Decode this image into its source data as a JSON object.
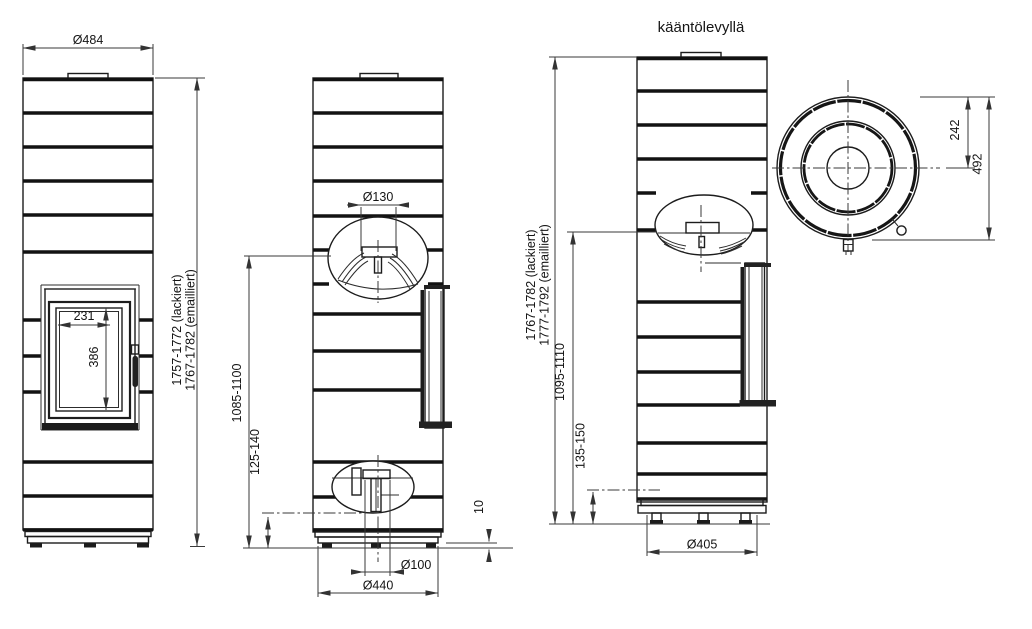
{
  "title": "kääntölevyllä",
  "colors": {
    "line": "#1c1c1c",
    "dim_line": "#3a3a3a",
    "background": "#ffffff"
  },
  "dims": {
    "front": {
      "top_diameter": "Ø484",
      "glass_width": "231",
      "glass_height": "386",
      "height_painted": "1757-1772 (lackiert)",
      "height_enamelled": "1767-1782 (emailliert)"
    },
    "side": {
      "flue_diameter": "Ø130",
      "flue_center_height": "1085-1100",
      "inlet_center_height": "125-140",
      "foot_clearance": "10",
      "inlet_diameter": "Ø100",
      "base_diameter": "Ø440"
    },
    "rear": {
      "height_painted": "1767-1782 (lackiert)",
      "height_enamelled": "1777-1792 (emailliert)",
      "flue_center_height": "1095-1110",
      "inlet_center_height": "135-150",
      "base_diameter": "Ø405"
    },
    "top": {
      "flue_offset": "242",
      "outer_diameter": "492"
    }
  }
}
